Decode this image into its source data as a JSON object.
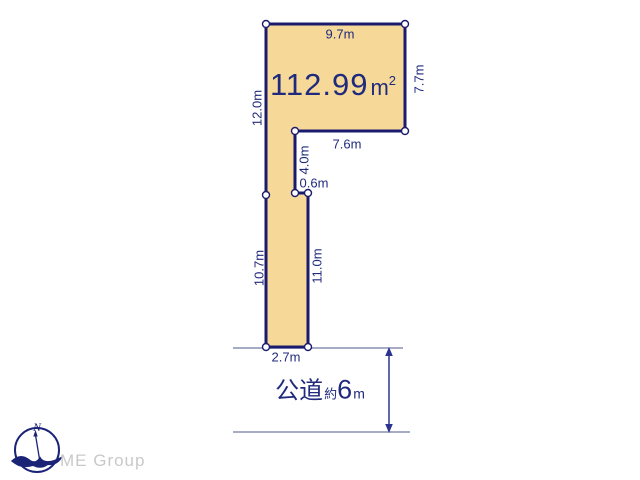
{
  "diagram": {
    "area": {
      "value": "112.99",
      "unit": "m",
      "superscript": "2"
    },
    "dimensions": {
      "top_width": "9.7m",
      "right_height": "7.7m",
      "left_upper_height": "12.0m",
      "notch_width": "7.6m",
      "notch_depth": "4.0m",
      "step_width": "0.6m",
      "left_lower_height": "10.7m",
      "strip_right_height": "11.0m",
      "frontage_width": "2.7m"
    },
    "road": {
      "name": "公道",
      "approx": "約",
      "width_value": "6",
      "width_unit": "m"
    },
    "colors": {
      "parcel_fill": "#F6D999",
      "parcel_border": "#1B1B6E",
      "label_text": "#202A7C",
      "road_line": "#8890B4",
      "arrow": "#2A3490",
      "logo_text": "#C9C9C9"
    }
  },
  "compass": {
    "north_label": "N"
  },
  "logo": {
    "text": "ME Group"
  }
}
